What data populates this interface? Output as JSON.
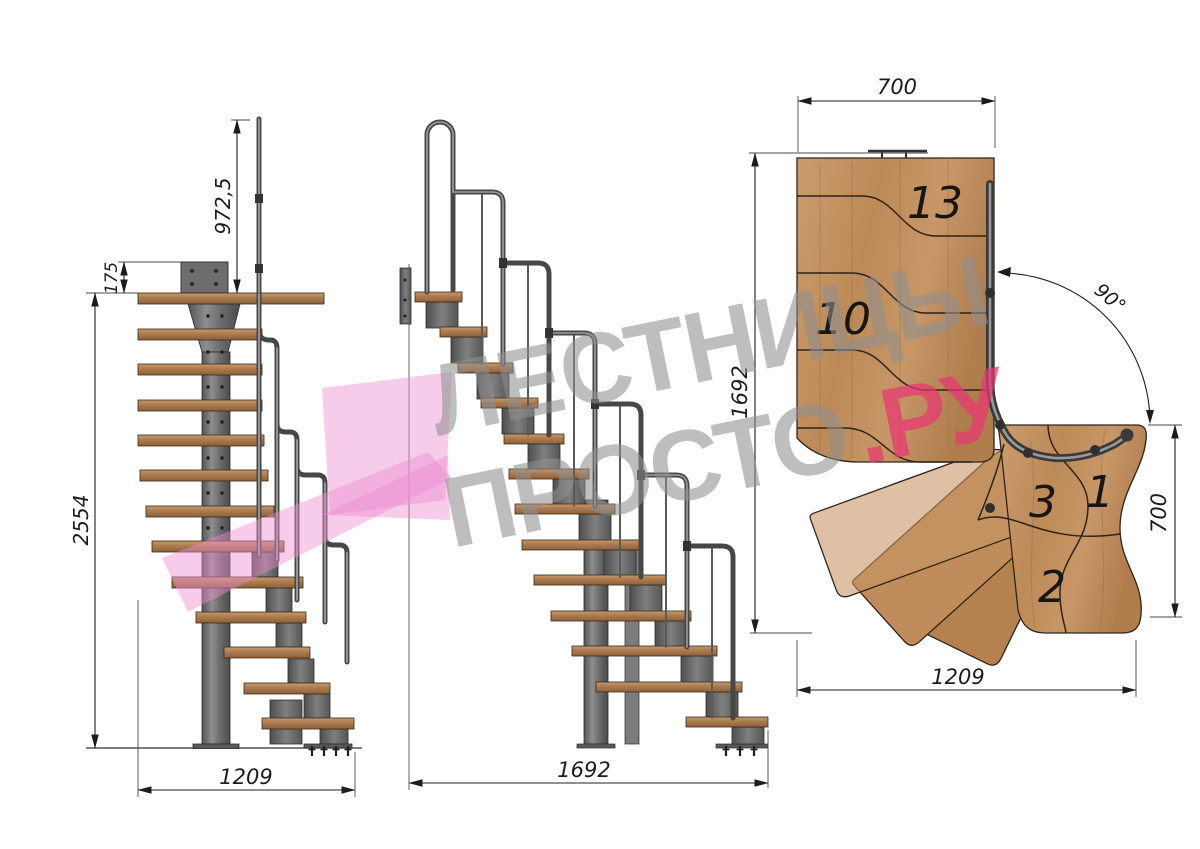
{
  "watermark": {
    "line1": "ЛЕСТНИЦЫ",
    "line2": "ПРОСТО",
    "line2_suffix": ".РУ"
  },
  "front_view": {
    "dim_railing_height": "972,5",
    "dim_plate_offset": "175",
    "dim_total_height": "2554",
    "dim_width": "1209"
  },
  "side_view": {
    "dim_total_run": "1692"
  },
  "plan_view": {
    "dim_top_width": "700",
    "dim_left_depth": "1692",
    "dim_turn_angle": "90°",
    "dim_right_width": "700",
    "dim_bottom_width": "1209",
    "step_13": "13",
    "step_10": "10",
    "step_3": "3",
    "step_1": "1",
    "step_2": "2"
  },
  "colors": {
    "wood_plan": "#c49263",
    "wood_side": "#a9764e",
    "steel": "#6f6f6f",
    "dimension_line": "#1f1f1f",
    "watermark_gray": "#8f8f8f",
    "watermark_pink": "#e73672",
    "logo_pink": "#ee8fd0"
  }
}
